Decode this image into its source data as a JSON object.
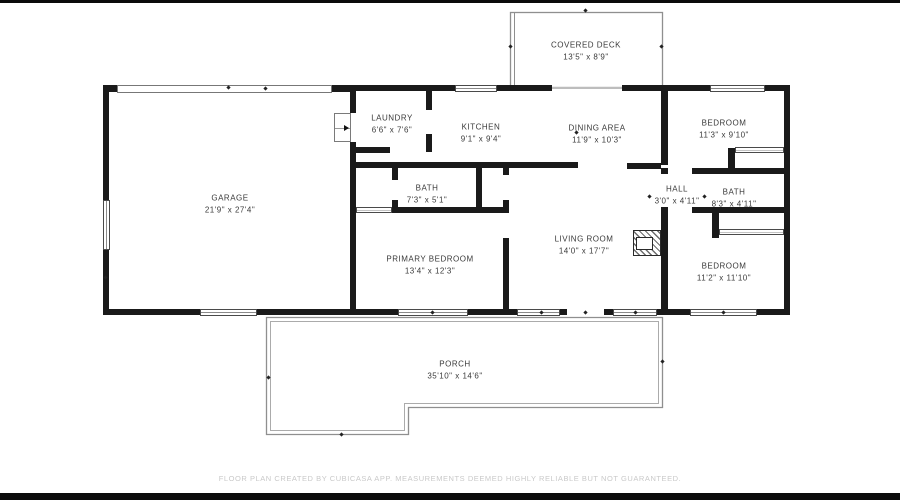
{
  "rooms": {
    "covered_deck": {
      "name": "COVERED DECK",
      "dims": "13'5\" x 8'9\""
    },
    "garage": {
      "name": "GARAGE",
      "dims": "21'9\" x 27'4\""
    },
    "laundry": {
      "name": "LAUNDRY",
      "dims": "6'6\" x 7'6\""
    },
    "kitchen": {
      "name": "KITCHEN",
      "dims": "9'1\" x 9'4\""
    },
    "dining_area": {
      "name": "DINING AREA",
      "dims": "11'9\" x 10'3\""
    },
    "bedroom_top_right": {
      "name": "BEDROOM",
      "dims": "11'3\" x 9'10\""
    },
    "bath_main": {
      "name": "BATH",
      "dims": "7'3\" x 5'1\""
    },
    "hall": {
      "name": "HALL",
      "dims": "3'0\" x 4'11\""
    },
    "bath_hall": {
      "name": "BATH",
      "dims": "8'3\" x 4'11\""
    },
    "living_room": {
      "name": "LIVING ROOM",
      "dims": "14'0\" x 17'7\""
    },
    "primary_bedroom": {
      "name": "PRIMARY BEDROOM",
      "dims": "13'4\" x 12'3\""
    },
    "bedroom_bottom_right": {
      "name": "BEDROOM",
      "dims": "11'2\" x 11'10\""
    },
    "porch": {
      "name": "PORCH",
      "dims": "35'10\" x 14'6\""
    }
  },
  "footer": {
    "text": "FLOOR PLAN CREATED BY CUBICASA APP. MEASUREMENTS DEEMED HIGHLY RELIABLE BUT NOT GUARANTEED."
  },
  "colors": {
    "wall": "#1a1a1a",
    "window_frame": "#4a4a4a",
    "thin_outline": "#949494",
    "label_text": "#3a3a3a",
    "footer_text": "#c9c9c9",
    "background": "#ffffff"
  }
}
